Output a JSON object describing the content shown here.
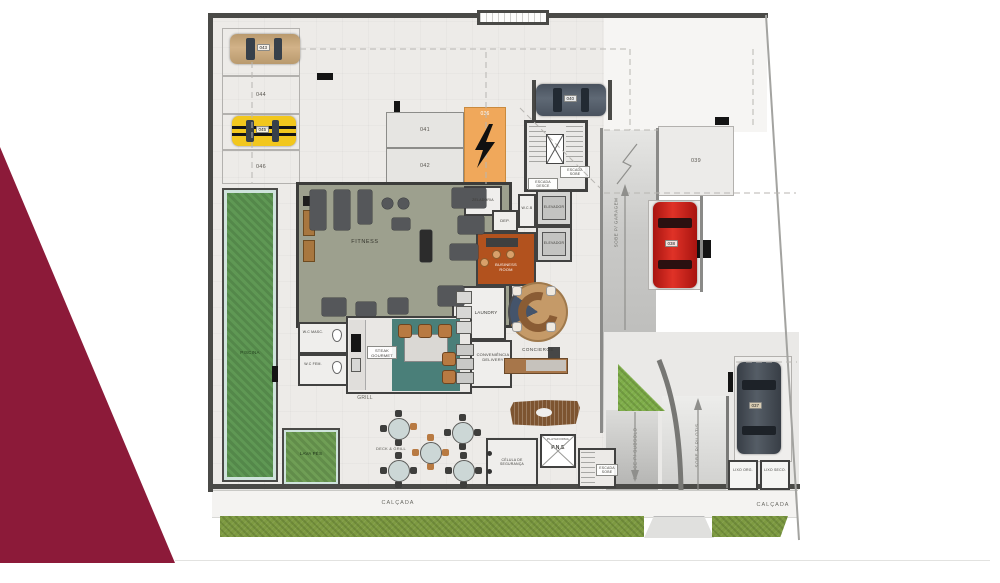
{
  "title": "Ground floor plan (pilotis) with parking, leisure and service areas",
  "colors": {
    "maroon_wedge": "#8c1a39",
    "plan_floor": "#edebe8",
    "walls": "#4a4a47",
    "fitness_floor": "#9da08e",
    "pool_green": "#5f9854",
    "grass_strip": "#7d9a41",
    "teal_counter": "#4a7f79",
    "business_floor": "#b2521e",
    "ev_stall_orange": "#f0a85b",
    "wood_brown": "#8a5c34",
    "car_tan": "#c2a377",
    "car_yellow": "#f2c71d",
    "car_slate": "#57616d",
    "car_red": "#cf1f17",
    "car_charcoal": "#464c54"
  },
  "stalls": {
    "s036": "036",
    "s037": "037",
    "s038": "038",
    "s039": "039",
    "s040": "040",
    "s041": "041",
    "s042": "042",
    "s043": "043",
    "s044": "044",
    "s045": "045",
    "s046": "046"
  },
  "rooms": {
    "fitness": "FITNESS",
    "zeladoria": "ZELADORIA",
    "dep": "DEP.",
    "wcb": "W.C.B",
    "elevador": "ELEVADOR",
    "escada_sobe": "ESCADA SOBE",
    "escada_desce": "ESCADA DESCE",
    "business": "BUSINESS ROOM",
    "laundry": "LAUNDRY",
    "conveniencia": "CONVENIÊNCIA DELIVERY",
    "concierge": "CONCIERGE",
    "wc_masc": "W.C MASC.",
    "wc_fem": "W.C FEM.",
    "steak": "STEAK GOURMET",
    "grill": "GRILL",
    "deck_grill": "DECK & GRILL",
    "piscina": "PISCINA",
    "lava_pes": "LAVA PÉS",
    "celula": "CÉLULA DE SEGURANÇA",
    "plataforma_caption": "PLATAFORMA",
    "plataforma_abbr": "P.N.E",
    "lixo_org": "LIXO ORG.",
    "lixo_seco": "LIXO SECO."
  },
  "circulation": {
    "calcada": "CALÇADA",
    "sobe_garagem": "SOBE P/ GARAGEM",
    "desce_subsolo": "DESCE P/ SUBSOLO",
    "sobe_pilotis": "SOBE P/ PILOTIS"
  }
}
